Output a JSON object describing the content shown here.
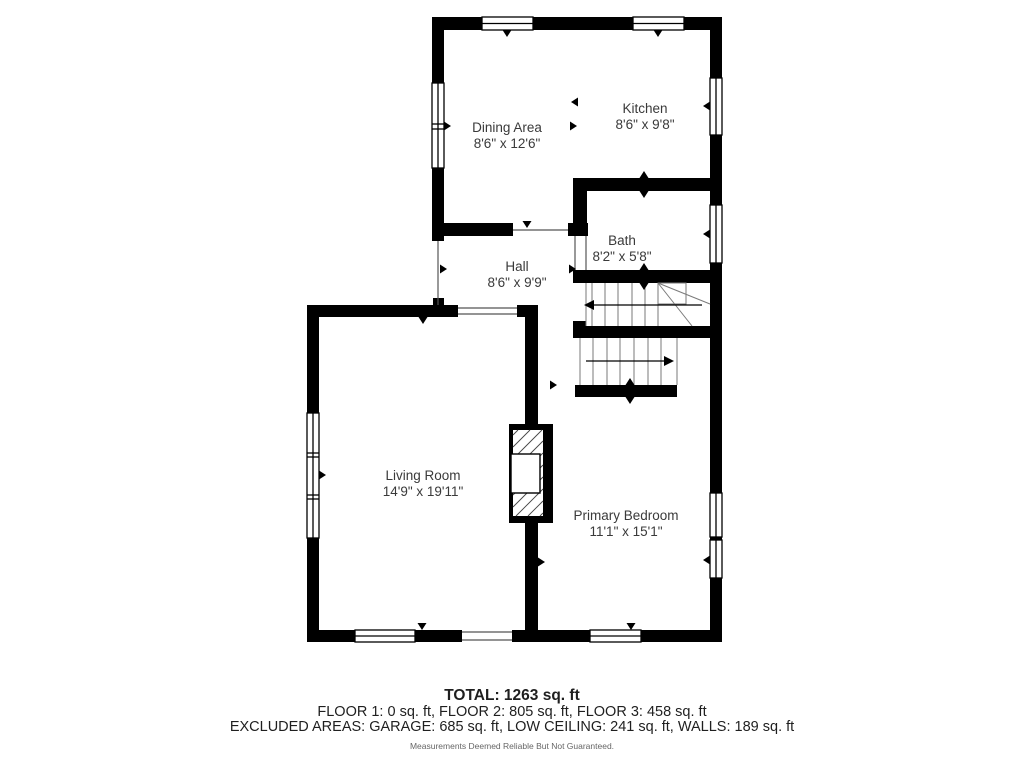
{
  "rooms": [
    {
      "name": "Dining Area",
      "dims": "8'6\" x 12'6\""
    },
    {
      "name": "Kitchen",
      "dims": "8'6\" x 9'8\""
    },
    {
      "name": "Bath",
      "dims": "8'2\" x 5'8\""
    },
    {
      "name": "Hall",
      "dims": "8'6\" x 9'9\""
    },
    {
      "name": "Living Room",
      "dims": "14'9\" x 19'11\""
    },
    {
      "name": "Primary Bedroom",
      "dims": "11'1\" x 15'1\""
    }
  ],
  "stairs": {
    "upper_flight_direction": "left",
    "lower_flight_direction": "right"
  },
  "footer": {
    "total": "TOTAL: 1263 sq. ft",
    "floors": "FLOOR 1: 0 sq. ft, FLOOR 2: 805 sq. ft, FLOOR 3: 458 sq. ft",
    "excluded": "EXCLUDED AREAS: GARAGE: 685 sq. ft, LOW CEILING: 241 sq. ft, WALLS: 189 sq. ft",
    "disclaimer": "Measurements Deemed Reliable But Not Guaranteed."
  },
  "colors": {
    "wall": "#000000",
    "floor": "#ffffff",
    "label_text": "#3a3a3a",
    "thin_line": "#555555",
    "tread_line": "#7a7a7a",
    "hatch": "#444444"
  }
}
